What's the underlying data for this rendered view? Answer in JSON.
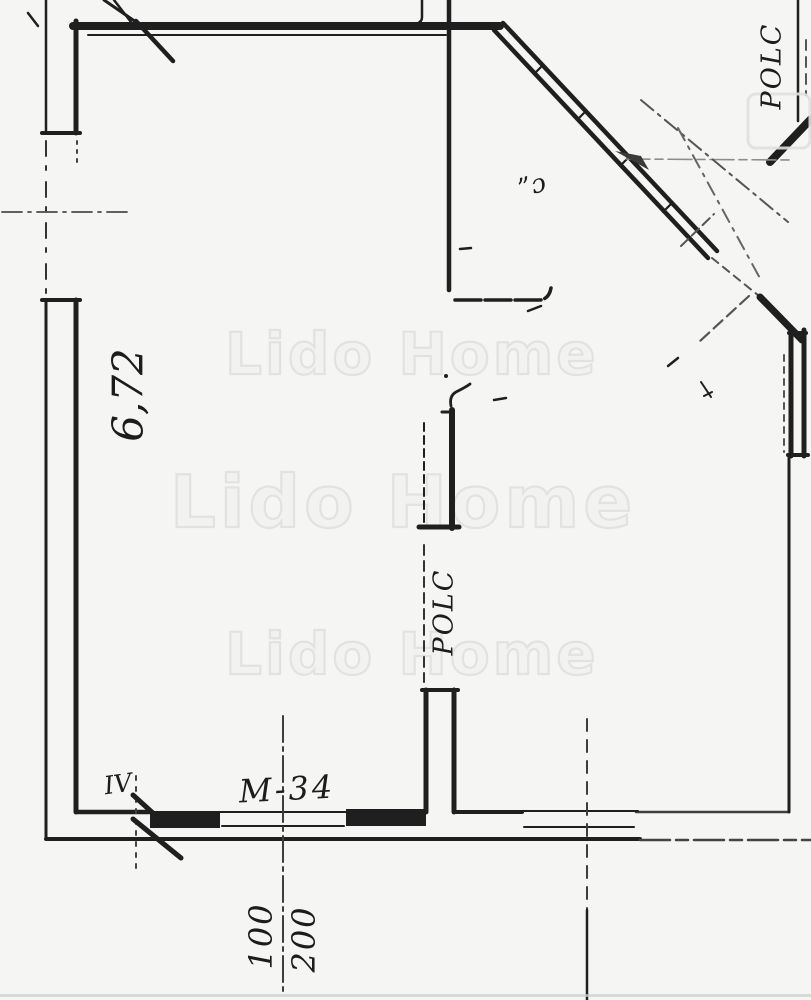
{
  "page": {
    "kind": "scanned architectural floor plan",
    "paper_color": "#f5f5f3",
    "ink_color": "#1f1f1f",
    "centerline_color": "#4a4a4a",
    "watermark_color": "#e2e2e0"
  },
  "watermark": {
    "text": "Lido Home"
  },
  "labels": {
    "room_area": "6,72",
    "shelf_upper": "POLC",
    "shelf_lower": "POLC",
    "corner_mark": "”ɔ",
    "door_mark": "IV",
    "scale_mark": "M-34",
    "dim_left": "100",
    "dim_right": "200"
  }
}
